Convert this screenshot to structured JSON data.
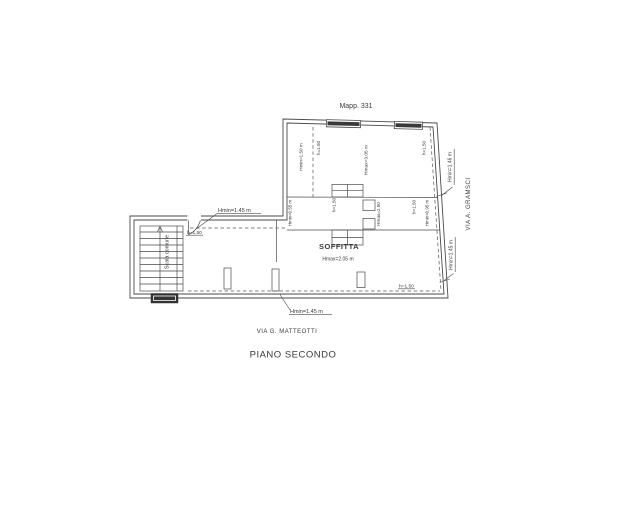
{
  "drawing": {
    "map_ref": "Mapp. 331",
    "plan_title": "PIANO SECONDO",
    "street_bottom": "VIA G. MATTEOTTI",
    "street_right": "VIA A. GRAMSCI",
    "room": {
      "name": "SOFFITTA",
      "height": "Hmax=2.05 m"
    },
    "stairs": "Scala comune",
    "upper_room": {
      "wall_left": "Hmin=1.50 m",
      "dash_left": "h=1.50",
      "ridge": "Hmax=3.05 m",
      "dash_right": "h=1.50"
    },
    "mid_band": {
      "left_dash": "h=1.50",
      "wall_left": "Hmin=0.55 m",
      "chimney": "Hmax=2.50",
      "right_dash": "h=1.50",
      "wall_right": "Hmin=0.95 m"
    },
    "leaders": {
      "strip_top": "Hmin=1.45 m",
      "strip_top_dash": "h=1.50",
      "bottom": "Hmin=1.45 m",
      "bottom_dash": "h=1.50",
      "right_top": "Hmin=1.46 m",
      "right_bottom": "Hmin=1.45 m"
    },
    "colors": {
      "line": "#4a4a4a",
      "text": "#3a3a3a",
      "background": "#ffffff"
    }
  }
}
